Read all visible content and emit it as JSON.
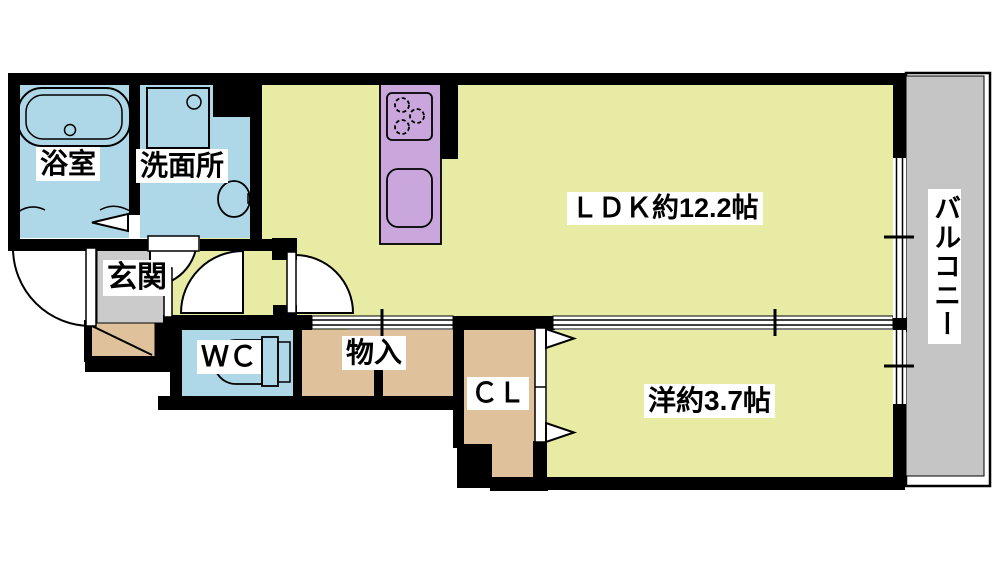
{
  "document": {
    "type": "apartment-floor-plan"
  },
  "rooms": {
    "bathroom": {
      "label": "浴室"
    },
    "washroom": {
      "label": "洗面所"
    },
    "ldk": {
      "label": "ＬＤＫ約12.2帖",
      "size_jo": "12.2"
    },
    "balcony": {
      "label": "バルコニー"
    },
    "entrance": {
      "label": "玄関"
    },
    "wc": {
      "label": "ＷＣ"
    },
    "storage": {
      "label": "物入"
    },
    "closet": {
      "label": "ＣＬ"
    },
    "western_room": {
      "label": "洋約3.7帖",
      "size_jo": "3.7"
    }
  },
  "colors": {
    "room_yellow": "#e7eba3",
    "water_blue": "#aed7e8",
    "kitchen_purple": "#c9a6dc",
    "storage_tan": "#dfc19b",
    "balcony_gray": "#c5c5c5",
    "entrance_gray": "#cbcbcb",
    "wall_black": "#000000"
  }
}
